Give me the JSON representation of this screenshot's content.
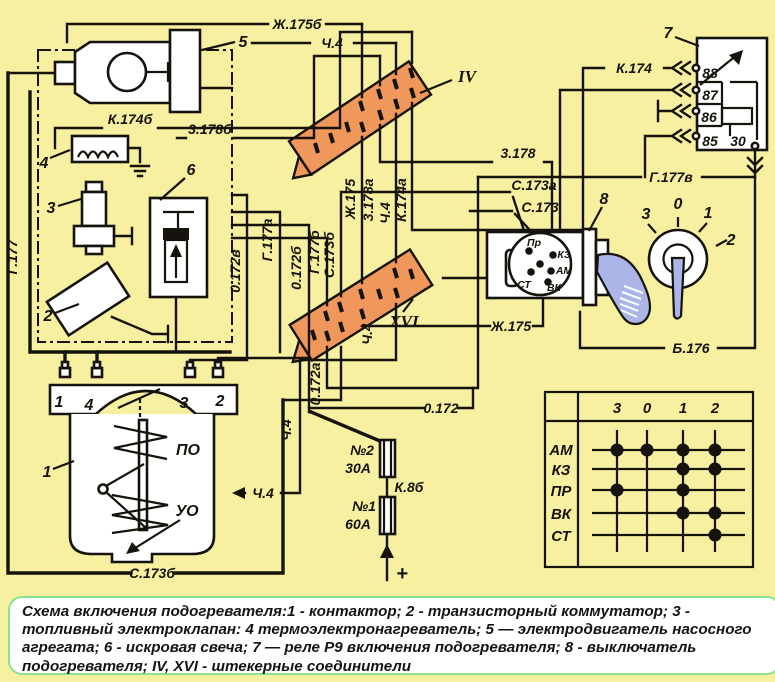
{
  "colors": {
    "background": "#f6f0a0",
    "line": "#15130c",
    "connector_fill": "#f0975b",
    "key_fill": "#acb5e8",
    "caption_border": "#8de08d",
    "caption_bg": "#ffffff"
  },
  "wires": {
    "zh175b": "Ж.175б",
    "ch4": "Ч.4",
    "k174b": "К.174б",
    "z178b": "3.178б",
    "g177": "Г.177",
    "g177a": "Г.177а",
    "g177b": "Г.177б",
    "g177v": "Г.177в",
    "o172": "0.172",
    "o172a": "0.172а",
    "o172b": "0.172б",
    "o172v": "0.172в",
    "s173": "С.173",
    "s173a": "С.173а",
    "s173b": "С.173б",
    "zh175": "Ж.175",
    "z178": "3.178",
    "z178a": "3.178а",
    "k174": "К.174",
    "k174a": "К.174а",
    "k8b": "К.8б",
    "b176": "Б.176",
    "plus": "+"
  },
  "components": {
    "contactor": "1",
    "commutator": "2",
    "valve": "3",
    "heater": "4",
    "motor": "5",
    "spark": "6",
    "relay": "7",
    "switch": "8",
    "conn4": "IV",
    "conn16": "XVI"
  },
  "relay_pins": [
    "88",
    "87",
    "86",
    "85",
    "30"
  ],
  "switch_terminals": {
    "pr": "Пр",
    "kz": "КЗ",
    "am": "АМ",
    "vk": "ВК",
    "st": "СТ"
  },
  "rotary_positions": [
    "3",
    "0",
    "1",
    "2"
  ],
  "contactor": {
    "terminals": [
      "1",
      "4",
      "3",
      "2"
    ],
    "coil_po": "ПО",
    "coil_uo": "УО"
  },
  "fuses": {
    "f2_name": "№2",
    "f2_rating": "30А",
    "f1_name": "№1",
    "f1_rating": "60А"
  },
  "table": {
    "columns": [
      "3",
      "0",
      "1",
      "2"
    ],
    "rows": [
      {
        "label": "АМ",
        "dots": [
          1,
          1,
          1,
          1
        ]
      },
      {
        "label": "КЗ",
        "dots": [
          0,
          0,
          1,
          1
        ]
      },
      {
        "label": "ПР",
        "dots": [
          1,
          0,
          1,
          0
        ]
      },
      {
        "label": "ВК",
        "dots": [
          0,
          0,
          1,
          1
        ]
      },
      {
        "label": "СТ",
        "dots": [
          0,
          0,
          0,
          1
        ]
      }
    ]
  },
  "caption": "Схема включения подогревателя:1 - контактор; 2 - транзисторный коммутатор; 3 - топливный электроклапан: 4 термоэлектронагреватель; 5 — электродвигатель насосного агрегата; 6 - искровая свеча; 7 — реле Р9 включения подогревателя; 8 - выключатель подогревателя; IV, XVI - штекерные соединители"
}
